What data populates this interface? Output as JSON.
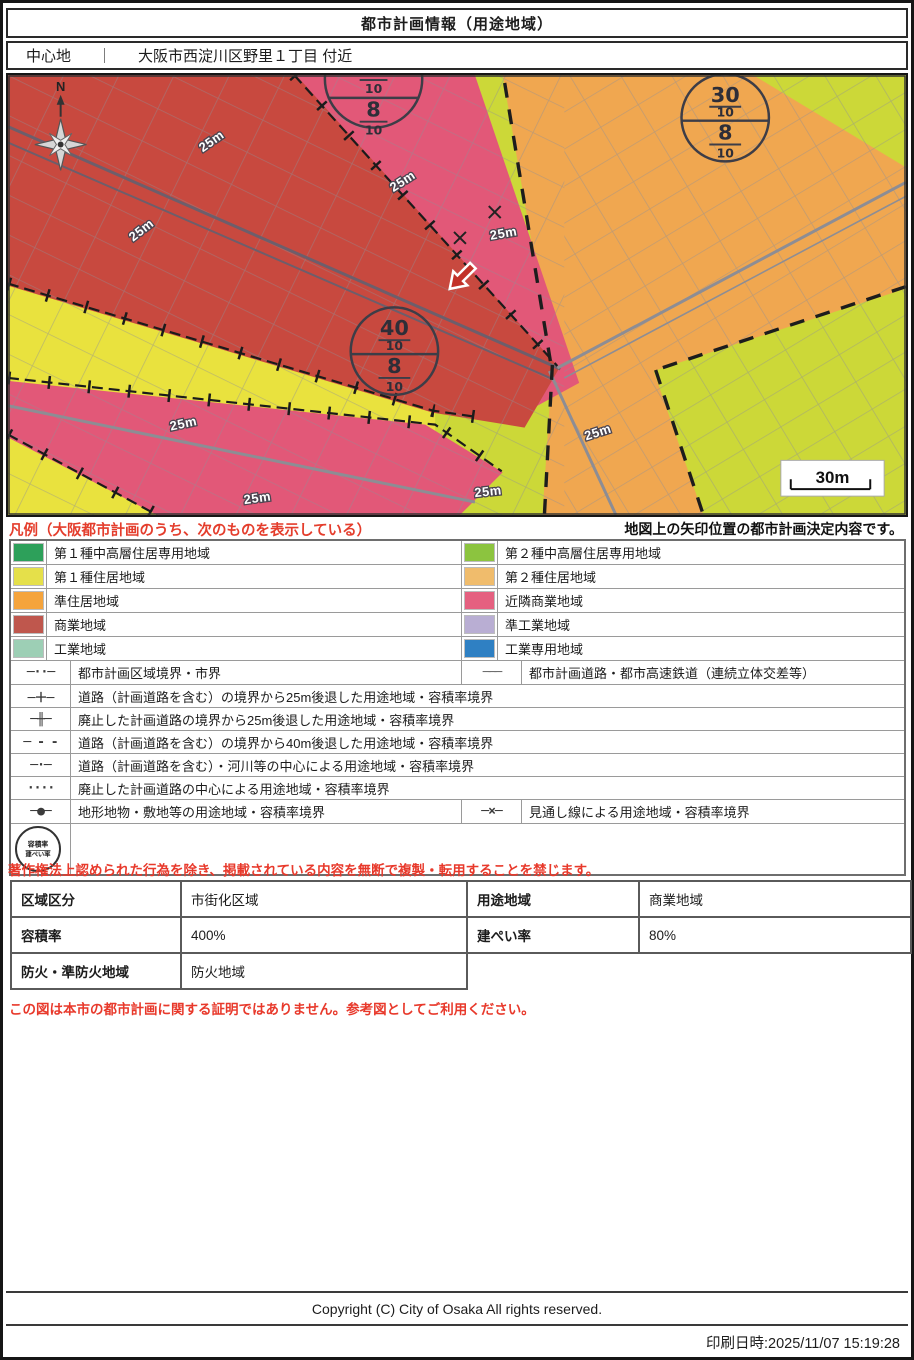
{
  "page": {
    "title": "都市計画情報（用途地域）",
    "center": {
      "label": "中心地",
      "separator": "｜",
      "value": "大阪市西淀川区野里１丁目 付近"
    }
  },
  "map": {
    "compass_label": "N",
    "setback_label": "25m",
    "scale_label": "30m",
    "stamps": {
      "top": {
        "values": [
          "10",
          "8",
          "10"
        ]
      },
      "right": {
        "values": [
          "30",
          "10",
          "8",
          "10"
        ]
      },
      "center": {
        "values": [
          "40",
          "10",
          "8",
          "10"
        ]
      }
    },
    "zone_colors": {
      "commercial": "#c8493f",
      "neighborhood_commercial": "#e25878",
      "residential_1_yellow": "#e9e23e",
      "residential_2_green": "#ccd838",
      "residential_2_orange": "#f0a750"
    }
  },
  "legend": {
    "title": "凡例（大阪都市計画のうち、次のものを表示している）",
    "arrow_note": "地図上の矢印位置の都市計画決定内容です。",
    "zones": [
      {
        "label": "第１種中高層住居専用地域",
        "color": "#2da05a"
      },
      {
        "label": "第２種中高層住居専用地域",
        "color": "#8cc43f"
      },
      {
        "label": "第１種住居地域",
        "color": "#e5e04a"
      },
      {
        "label": "第２種住居地域",
        "color": "#f0bc6c"
      },
      {
        "label": "準住居地域",
        "color": "#f5a43c"
      },
      {
        "label": "近隣商業地域",
        "color": "#e56080"
      },
      {
        "label": "商業地域",
        "color": "#bf574d"
      },
      {
        "label": "準工業地域",
        "color": "#b9aed3"
      },
      {
        "label": "工業地域",
        "color": "#9dcfb5"
      },
      {
        "label": "工業専用地域",
        "color": "#2f80c3"
      }
    ],
    "lines": [
      {
        "symbol": "─··─",
        "label": "都市計画区域境界・市界"
      },
      {
        "symbol": "───",
        "label": "都市計画道路・都市高速鉄道（連続立体交差等）"
      },
      {
        "symbol": "─＋─",
        "label": "道路（計画道路を含む）の境界から25m後退した用途地域・容積率境界"
      },
      {
        "symbol": "─╫─",
        "label": "廃止した計画道路の境界から25m後退した用途地域・容積率境界"
      },
      {
        "symbol": "─ - -",
        "label": "道路（計画道路を含む）の境界から40m後退した用途地域・容積率境界"
      },
      {
        "symbol": "─·─",
        "label": "道路（計画道路を含む）・河川等の中心による用途地域・容積率境界"
      },
      {
        "symbol": "····",
        "label": "廃止した計画道路の中心による用途地域・容積率境界"
      },
      {
        "symbol": "─●─",
        "label": "地形地物・敷地等の用途地域・容積率境界"
      },
      {
        "symbol": "─×─",
        "label": "見通し線による用途地域・容積率境界"
      }
    ],
    "stamp": {
      "top": "容積率",
      "bottom": "建ぺい率"
    }
  },
  "copyright_warning": "著作権法上認められた行為を除き、掲載されている内容を無断で複製・転用することを禁じます。",
  "info_table": {
    "rows": [
      {
        "h1": "区域区分",
        "v1": "市街化区域",
        "h2": "用途地域",
        "v2": "商業地域"
      },
      {
        "h1": "容積率",
        "v1": "400%",
        "h2": "建ぺい率",
        "v2": "80%"
      },
      {
        "h1": "防火・準防火地域",
        "v1": "防火地域"
      }
    ]
  },
  "reference_note": "この図は本市の都市計画に関する証明ではありません。参考図としてご利用ください。",
  "footer": {
    "copyright": "Copyright (C) City of Osaka All rights reserved.",
    "printed": "印刷日時:2025/11/07 15:19:28"
  }
}
